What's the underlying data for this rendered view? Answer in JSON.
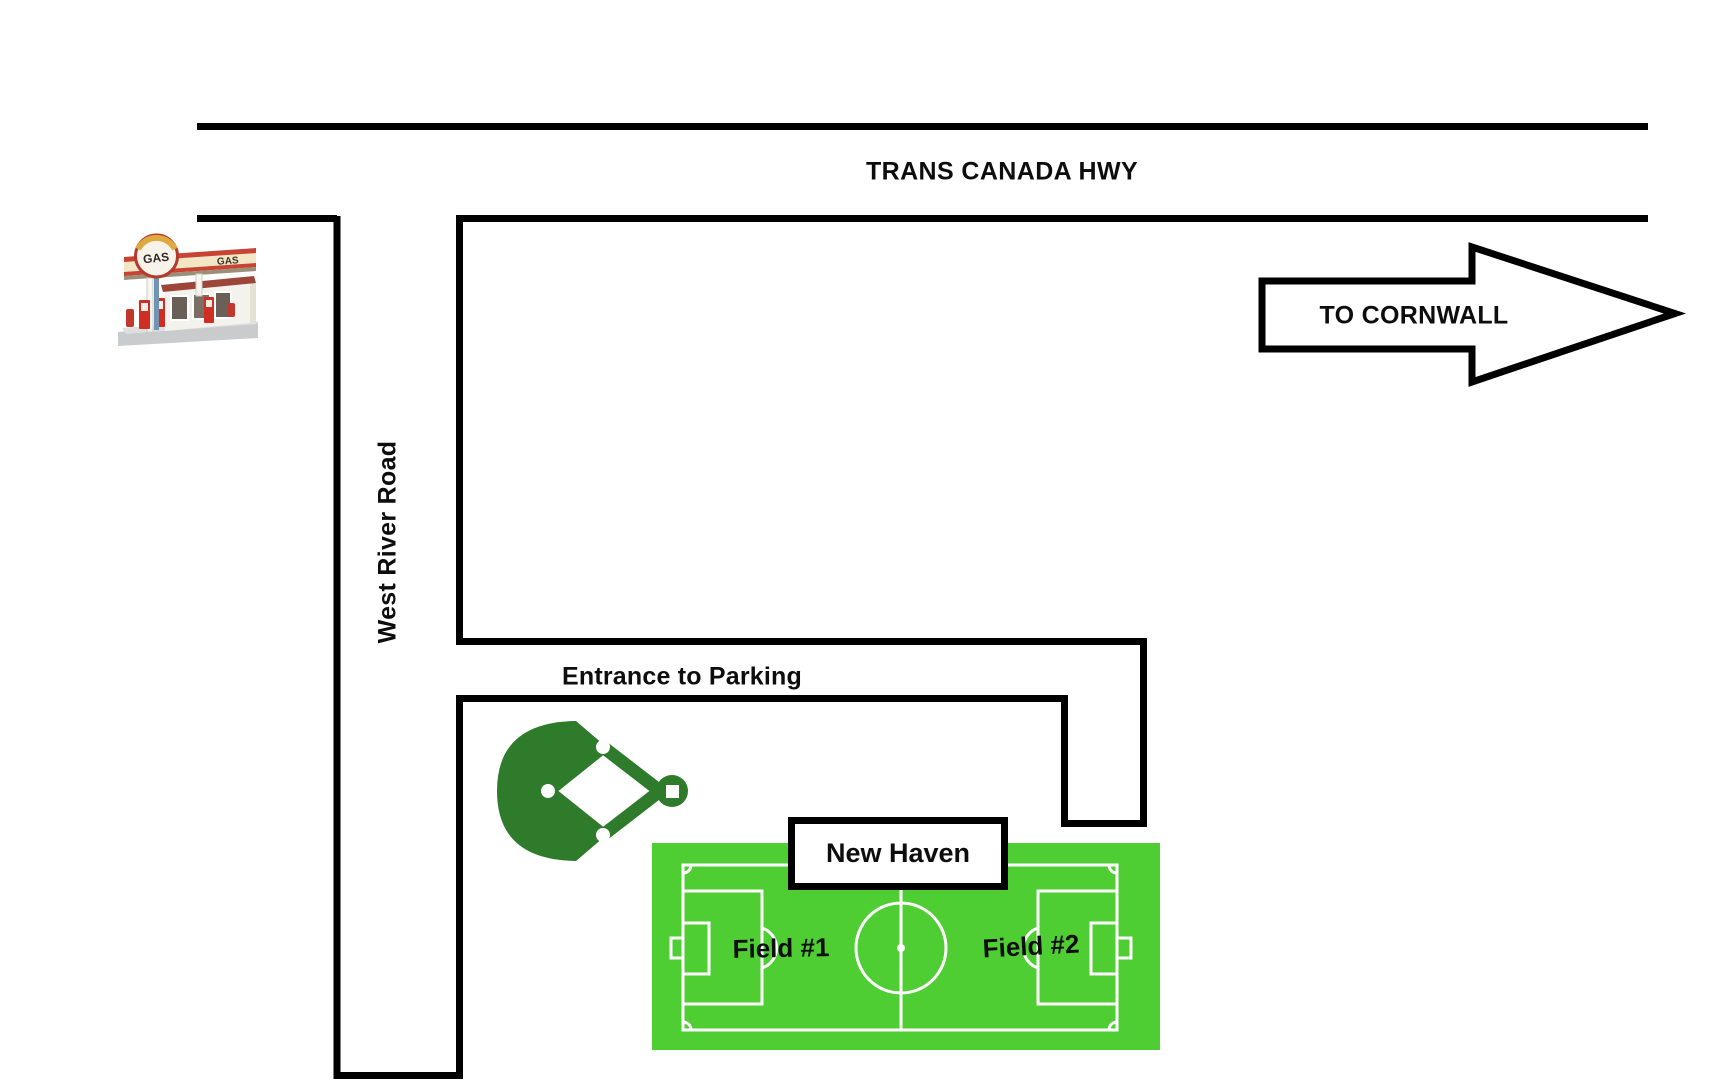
{
  "roads": {
    "highway": {
      "label": "TRANS CANADA HWY"
    },
    "west_river": {
      "label": "West River Road"
    },
    "entrance": {
      "label": "Entrance to Parking"
    }
  },
  "direction_arrow": {
    "label": "TO CORNWALL"
  },
  "venue": {
    "sign": "New Haven",
    "fields": [
      {
        "label": "Field #1"
      },
      {
        "label": "Field #2"
      }
    ]
  },
  "gas_station": {
    "sign_text": "GAS",
    "canopy_text": "GAS"
  },
  "icons": {
    "gas_station": "gas-station-icon",
    "baseball_diamond": "baseball-diamond-icon",
    "soccer_field": "soccer-field-icon",
    "direction_arrow": "right-arrow-icon"
  },
  "colors": {
    "road_line": "#000000",
    "soccer_green": "#4fce33",
    "pitch_line": "#ffffff",
    "baseball_green": "#2e7b2b",
    "label_text": "#0d0d0d",
    "sign_background": "#ffffff"
  }
}
